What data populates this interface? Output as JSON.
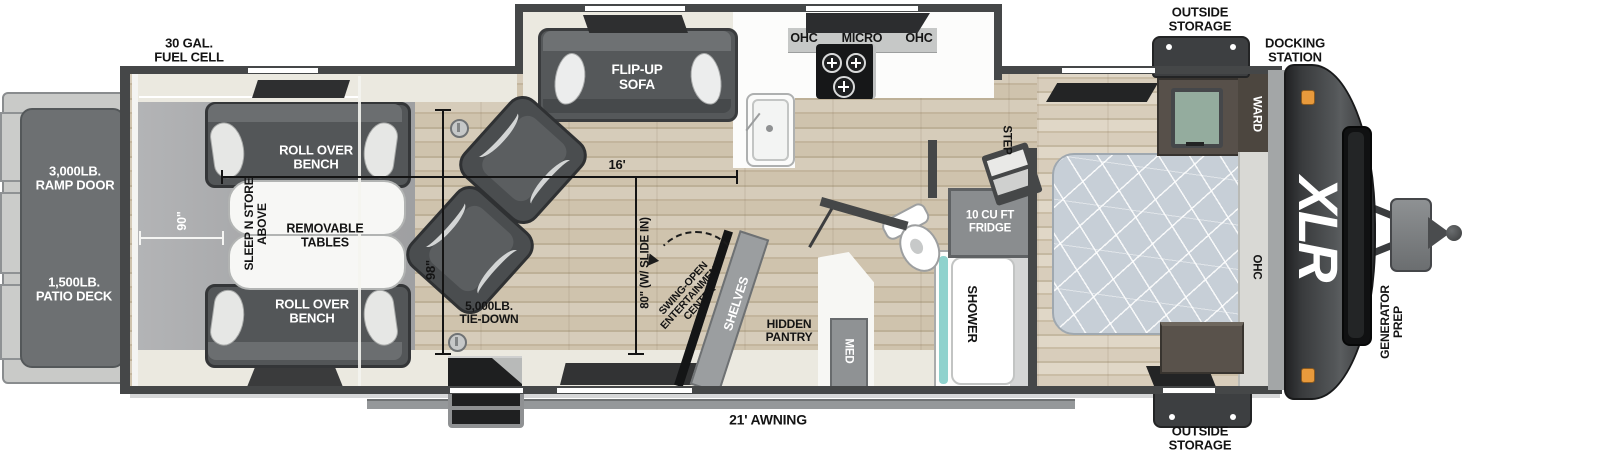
{
  "plan": {
    "brand_logo": "XLR",
    "rear_deck": {
      "ramp_door": "3,000LB.\nRAMP DOOR",
      "patio_deck": "1,500LB.\nPATIO DECK"
    },
    "exterior": {
      "fuel_cell": "30 GAL.\nFUEL CELL",
      "outside_storage_top": "OUTSIDE\nSTORAGE",
      "docking_station": "DOCKING\nSTATION",
      "outside_storage_bottom": "OUTSIDE\nSTORAGE",
      "generator_prep": "GENERATOR\nPREP",
      "awning": "21' AWNING"
    },
    "garage": {
      "roll_over_bench_top": "ROLL OVER\nBENCH",
      "roll_over_bench_bottom": "ROLL OVER\nBENCH",
      "removable_tables": "REMOVABLE\nTABLES",
      "sleep_n_store": "SLEEP N STORE\nABOVE",
      "tie_down": "5,000LB.\nTIE-DOWN"
    },
    "dimensions": {
      "garage_width": "90\"",
      "main_length": "16'",
      "body_width": "98\"",
      "slide_width": "80\" (W/ SLIDE IN)"
    },
    "living": {
      "sofa": "FLIP-UP\nSOFA",
      "entertainment_center": "SWING-OPEN\nENTERTAINMENT\nCENTER",
      "shelves": "SHELVES",
      "hidden_pantry": "HIDDEN\nPANTRY"
    },
    "kitchen": {
      "ohc_left": "OHC",
      "micro": "MICRO",
      "ohc_right": "OHC"
    },
    "bath": {
      "med": "MED",
      "shower": "SHOWER",
      "fridge": "10 CU FT\nFRIDGE"
    },
    "bedroom": {
      "step": "STEP",
      "ward": "WARD",
      "ohc": "OHC"
    }
  },
  "colors": {
    "wall": "#454748",
    "garage_floor": "#a8a9ab",
    "aisle": "#ebe9e0",
    "mattress": "#c7cfd7",
    "shower_accent": "#8fd2cd",
    "marker_light": "#e89a3c",
    "front_cap": "#3b3d3f"
  }
}
